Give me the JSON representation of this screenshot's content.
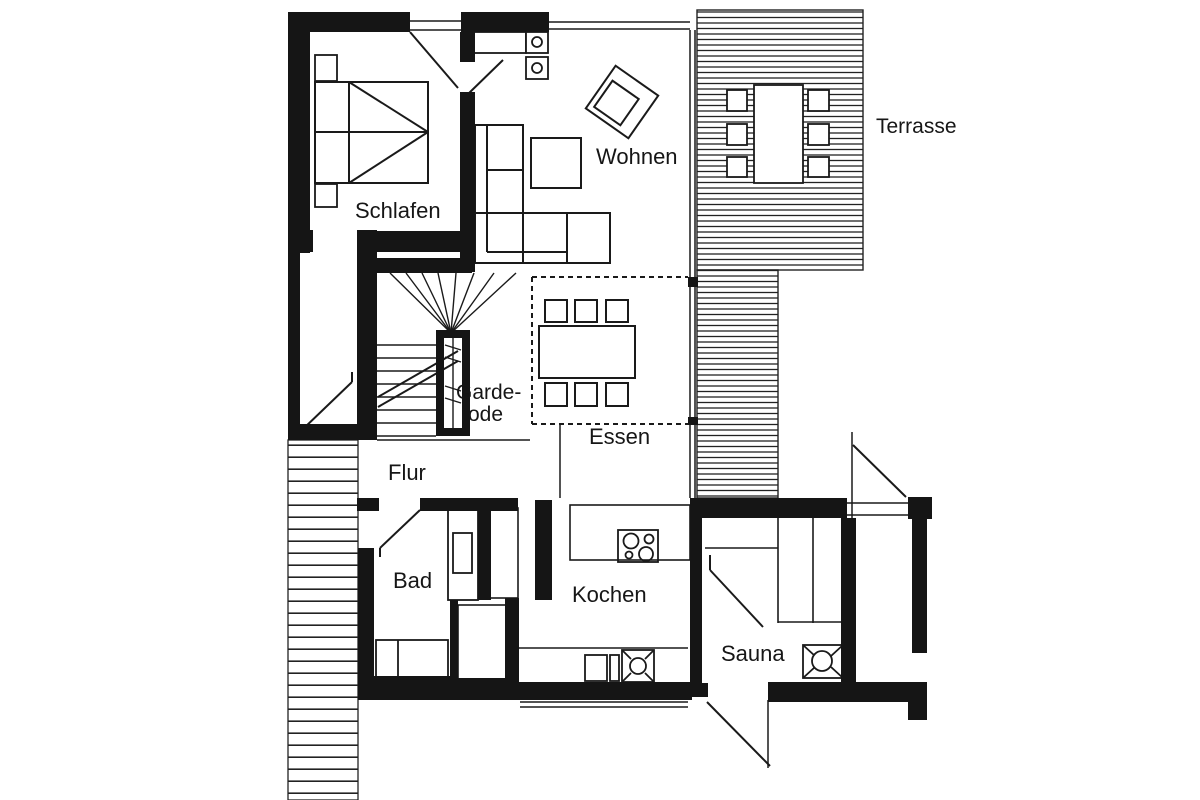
{
  "drawing": {
    "type": "floor-plan",
    "description": "Scanned black-and-white apartment floor plan with terrace",
    "language": "German"
  },
  "labels": {
    "schlafen": "Schlafen",
    "wohnen": "Wohnen",
    "terrasse": "Terrasse",
    "garderobe_line1": "Garde-",
    "garderobe_line2": "rode",
    "essen": "Essen",
    "flur": "Flur",
    "bad": "Bad",
    "kochen": "Kochen",
    "sauna": "Sauna"
  },
  "colors": {
    "wall": "#151515",
    "line": "#1a1a1a",
    "paper": "#ffffff",
    "hatch": "#222222"
  },
  "rooms": [
    {
      "name": "Schlafen",
      "meaning": "bedroom"
    },
    {
      "name": "Wohnen",
      "meaning": "living room"
    },
    {
      "name": "Terrasse",
      "meaning": "terrace"
    },
    {
      "name": "Garde-rode",
      "meaning": "wardrobe"
    },
    {
      "name": "Essen",
      "meaning": "dining area"
    },
    {
      "name": "Flur",
      "meaning": "hallway"
    },
    {
      "name": "Bad",
      "meaning": "bathroom"
    },
    {
      "name": "Kochen",
      "meaning": "kitchen"
    },
    {
      "name": "Sauna",
      "meaning": "sauna"
    }
  ],
  "furniture_symbols": [
    "double-bed",
    "nightstand",
    "sectional-sofa",
    "coffee-table",
    "armchair",
    "dining-table-six-chairs",
    "terrace-table-six-chairs",
    "winder-staircase",
    "wardrobe-closet",
    "shower-tray",
    "bathroom-fixture",
    "kitchen-counter",
    "cooktop-four-burners",
    "kitchen-sink",
    "sauna-bench",
    "sauna-heater",
    "door-swing",
    "window",
    "deck-hatching",
    "exterior-steps"
  ]
}
